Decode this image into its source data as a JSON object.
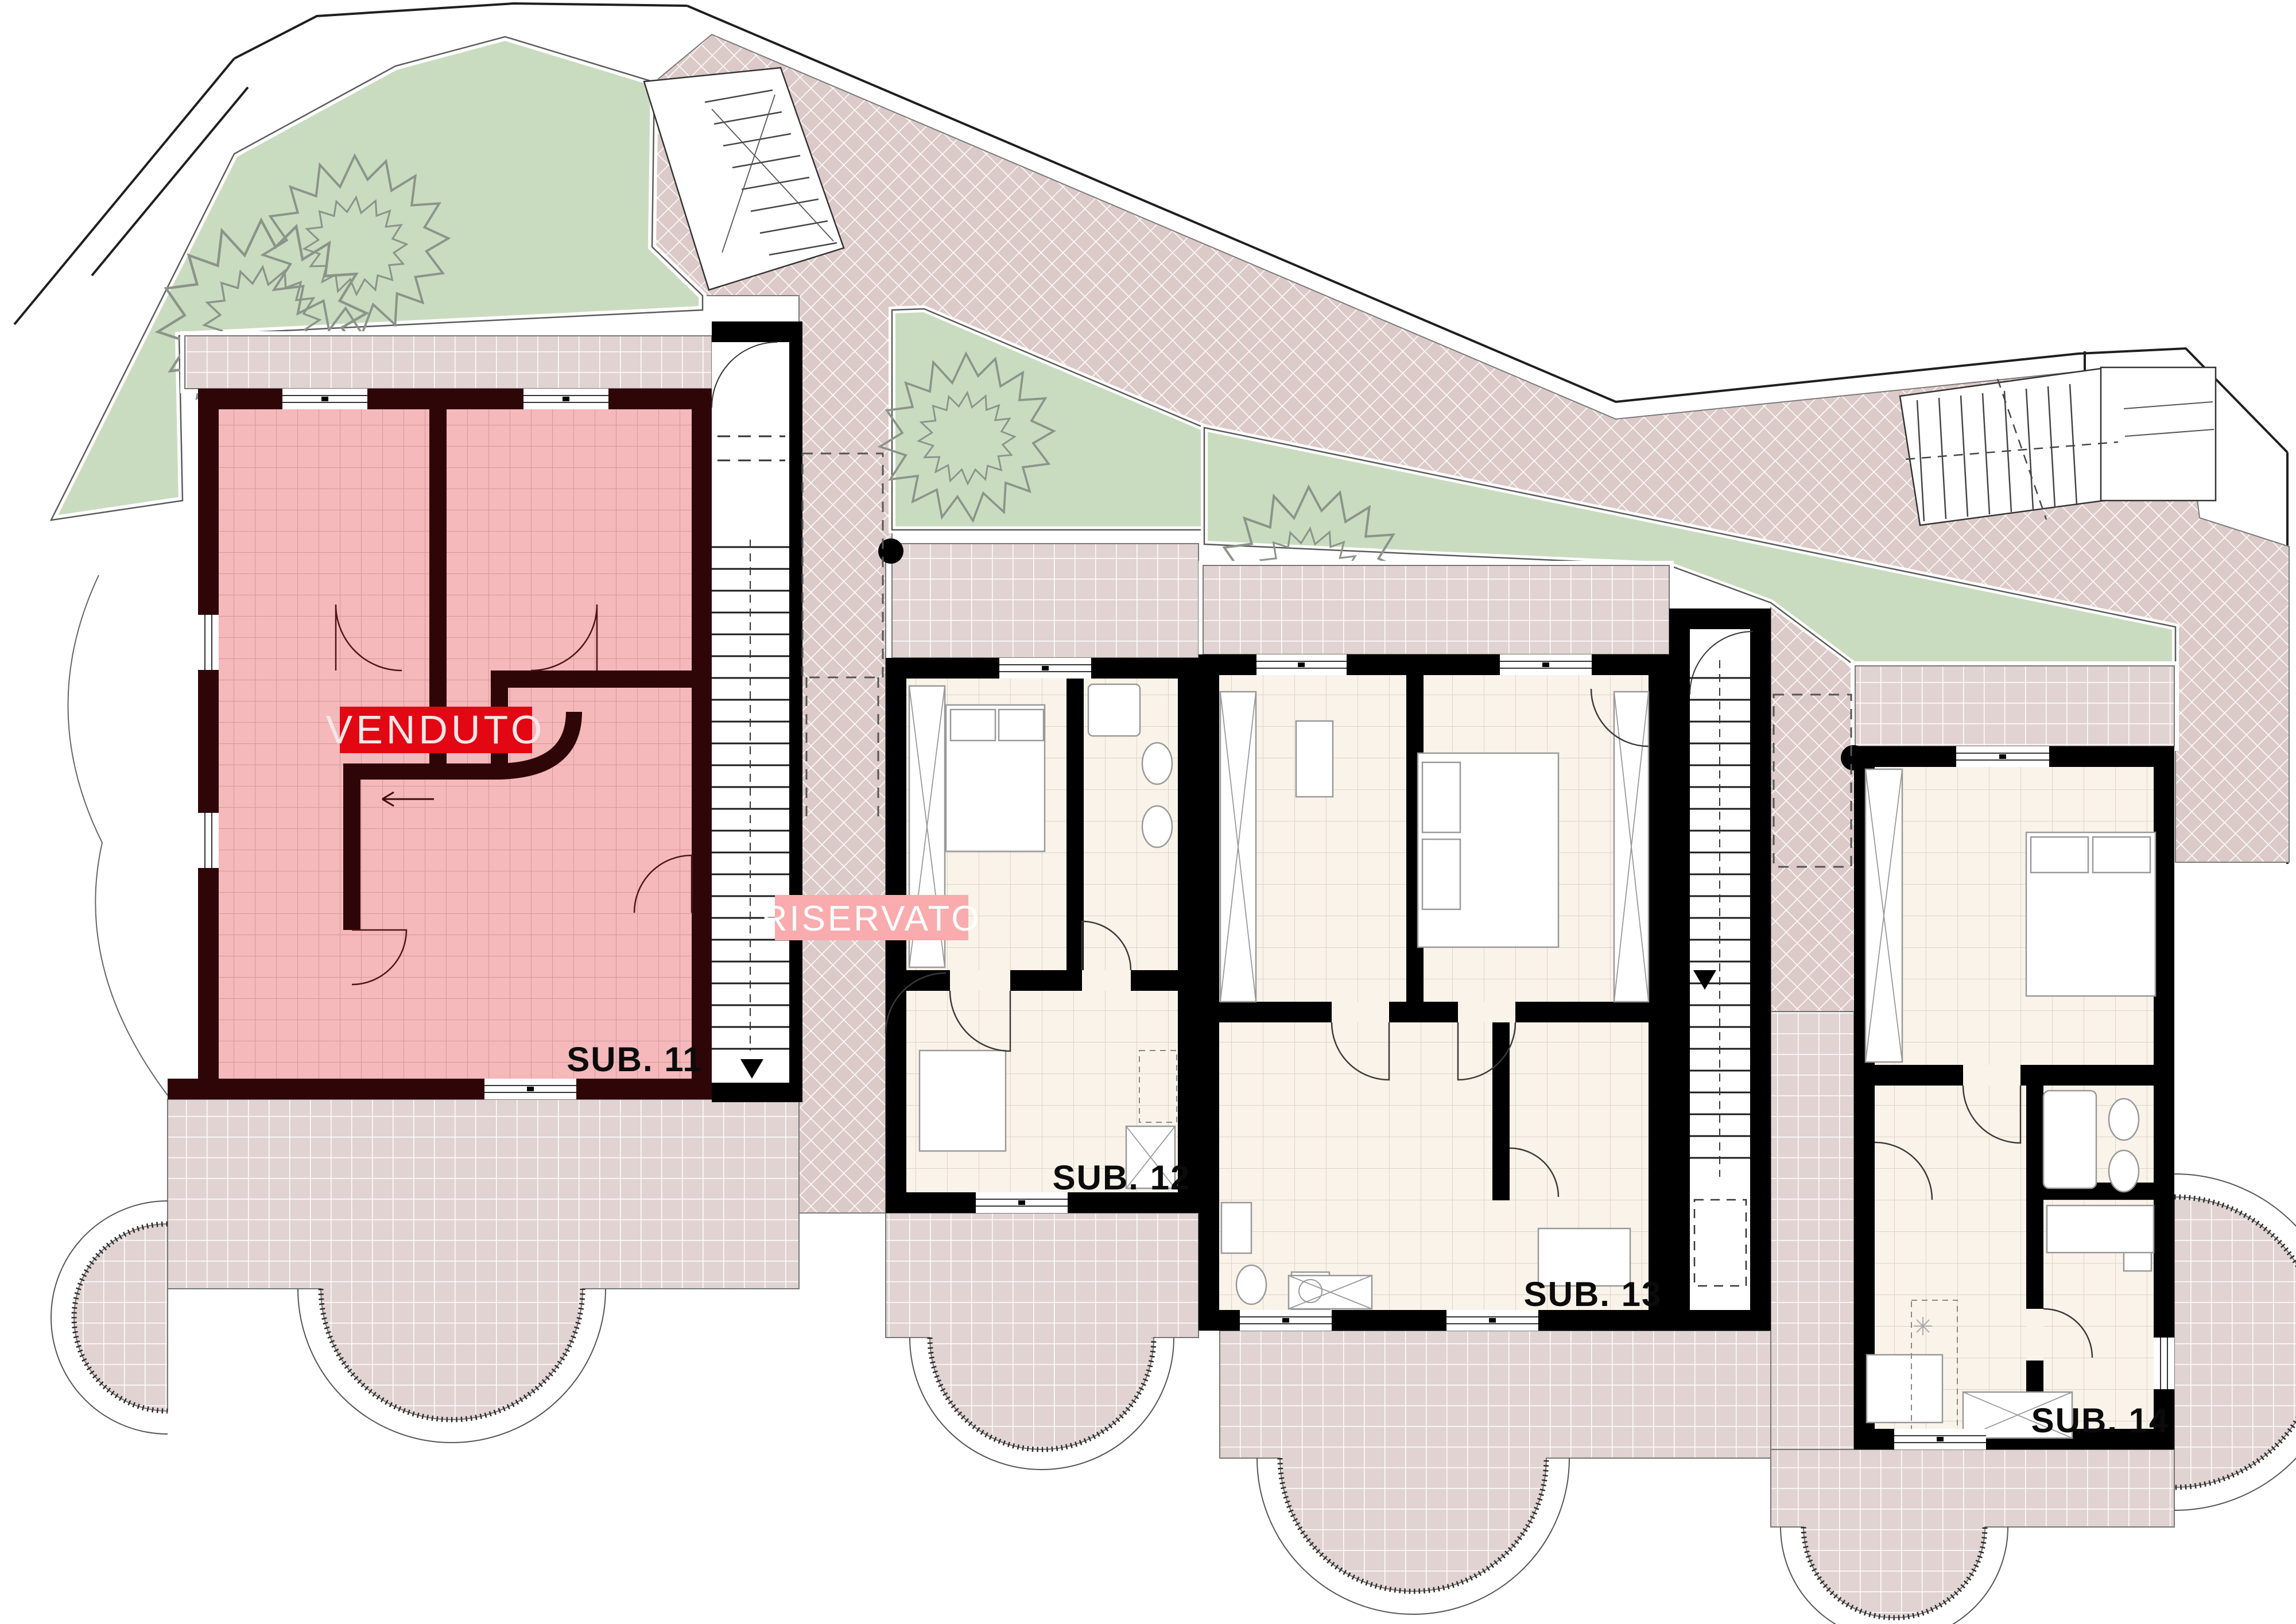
{
  "plan": {
    "units": [
      {
        "label": "SUB. 11",
        "overlay": "VENDUTO"
      },
      {
        "label": "SUB. 12",
        "overlay": "RISERVATO"
      },
      {
        "label": "SUB. 13"
      },
      {
        "label": "SUB. 14"
      }
    ],
    "colors": {
      "sold_unit_fill": "#f5b8bb",
      "sold_unit_wall": "#2f0608",
      "sold_badge": "#e30613",
      "reserved_badge": "#f9abae",
      "garden": "#cadcc0",
      "walkway": "#dccac8",
      "terrace": "#e0d3d2",
      "room_floor": "#faf3e9",
      "wall": "#000000"
    }
  }
}
